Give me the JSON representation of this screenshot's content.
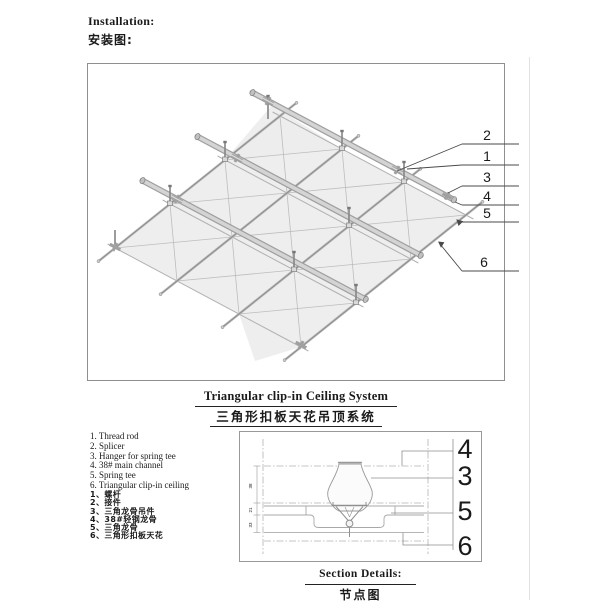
{
  "header": {
    "en": "Installation:",
    "zh": "安装图:"
  },
  "diagram": {
    "callouts": [
      "2",
      "1",
      "3",
      "4",
      "5",
      "6"
    ]
  },
  "title": {
    "en": "Triangular clip-in Ceiling System",
    "zh": "三角形扣板天花吊顶系统"
  },
  "legend_en": [
    "1. Thread rod",
    "2. Splicer",
    "3. Hanger for spring tee",
    "4. 38# main channel",
    "5. Spring tee",
    "6. Triangular clip-in ceiling"
  ],
  "legend_zh": [
    "1、螺杆",
    "2、接件",
    "3、三角龙骨吊件",
    "4、38#轻钢龙骨",
    "5、三角龙骨",
    "6、三角形扣板天花"
  ],
  "section": {
    "callouts": [
      "4",
      "3",
      "5",
      "6"
    ],
    "dims": [
      "38",
      "21",
      "33"
    ],
    "title_en": "Section Details:",
    "title_zh": "节点图"
  },
  "colors": {
    "line": "#8a8a8a",
    "panel": "#ececec",
    "text": "#1a1a1a"
  }
}
